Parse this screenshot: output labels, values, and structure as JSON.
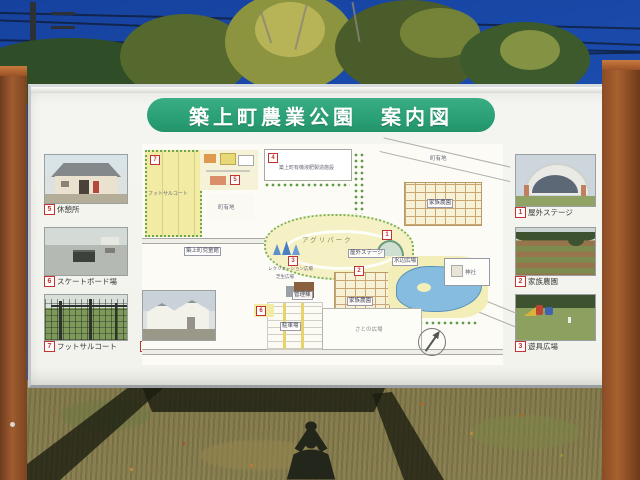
{
  "sign": {
    "title": "築上町農業公園　案内図"
  },
  "photos": {
    "left": [
      {
        "num": "5",
        "label": "休憩所"
      },
      {
        "num": "6",
        "label": "スケートボード場"
      },
      {
        "num": "7",
        "label": "フットサルコート"
      }
    ],
    "mid": [
      {
        "num": "4",
        "label": "有機液肥製造施設"
      }
    ],
    "right": [
      {
        "num": "1",
        "label": "屋外ステージ"
      },
      {
        "num": "2",
        "label": "家族農園"
      },
      {
        "num": "3",
        "label": "遊具広場"
      }
    ]
  },
  "map": {
    "labels": {
      "futsal": "フットサルコート",
      "children_hall": "築上町児童館",
      "fertilizer": "築上町有機液肥製造施設",
      "agri_park": "アグリパーク",
      "recreation": "レクリエーション広場",
      "lawn": "芝生広場",
      "admin": "管理棟",
      "stage": "屋外ステージ",
      "family_farm": "家族農園",
      "waterside": "水辺広場",
      "shrine": "神社",
      "town_land": "町有地",
      "parking": "駐車場",
      "sato_plaza": "さとの広場"
    },
    "numbers": {
      "n1": "1",
      "n2": "2",
      "n3": "3",
      "n4": "4",
      "n5": "5",
      "n6": "6",
      "n7": "7"
    }
  },
  "colors": {
    "banner_green": "#2aa076",
    "number_red": "#c23432",
    "sky_top": "#16429e",
    "sky_bottom": "#2f6ccc",
    "map_yellow": "#f1eba3",
    "pond_blue": "#85bce0",
    "post_brown": "#9a5a30",
    "grass": "#8a7f52"
  }
}
